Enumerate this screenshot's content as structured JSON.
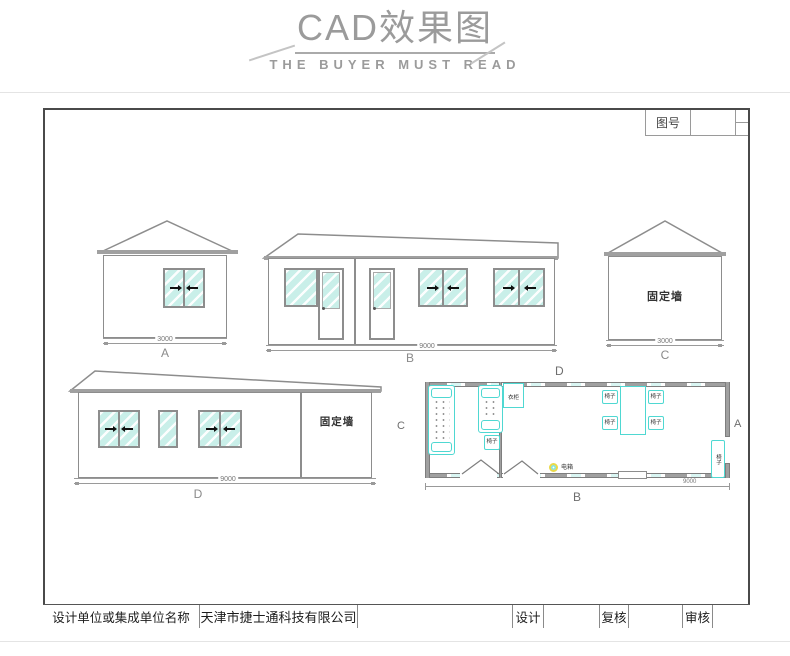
{
  "header": {
    "title": "CAD效果图",
    "subtitle": "THE BUYER MUST READ"
  },
  "sheet": {
    "drawing_no_label": "图号",
    "title_block": {
      "designer_label": "设计单位或集成单位名称",
      "company": "天津市捷士通科技有限公司",
      "design_label": "设计",
      "review_label": "复核",
      "audit_label": "审核"
    }
  },
  "elevations": {
    "a": {
      "label": "A",
      "dim": "3000"
    },
    "b": {
      "label": "B",
      "dim": "9000"
    },
    "c": {
      "label": "C",
      "dim": "3000",
      "wall_text": "固定墙"
    },
    "d": {
      "label": "D",
      "dim": "9000",
      "wall_text": "固定墙"
    }
  },
  "floor_plan": {
    "label_top": "D",
    "label_bottom": "B",
    "label_left": "C",
    "label_right": "A",
    "dim": "9000",
    "furniture": {
      "chair": "椅子",
      "wardrobe": "衣柜",
      "electric_box": "电箱"
    }
  },
  "icons": {
    "slide_arrow_left": "◄",
    "slide_arrow_right": "►",
    "electric_box_icon": "circle"
  },
  "colors": {
    "header_gray": "#9b9b9b",
    "line_gray": "#8d8d8d",
    "roof_gray": "#a0a0a0",
    "glass_cyan": "#c9efe9",
    "furniture_cyan": "#4fd8d2",
    "electric_yellow": "#ead94a"
  }
}
